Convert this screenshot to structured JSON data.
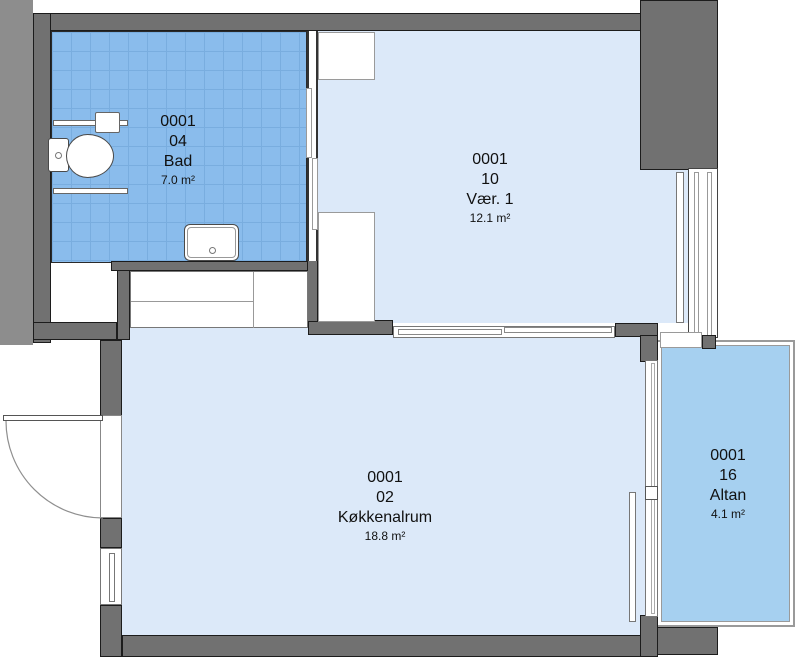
{
  "plan_title": "Apartment 0001 floor plan",
  "colors": {
    "wall": "#717171",
    "wall_outline": "#1c1c1c",
    "margin": "#8d8d8d",
    "room_light": "#dce9f9",
    "tile": "#8abcec",
    "tile_line": "#79addf",
    "balcony": "#a6d0f0",
    "frame_line": "#9a9a9a",
    "frame_dark": "#555555",
    "text": "#111111"
  },
  "rooms": [
    {
      "unit": "0001",
      "number": "04",
      "name": "Bad",
      "area": "7.0 m²"
    },
    {
      "unit": "0001",
      "number": "10",
      "name": "Vær. 1",
      "area": "12.1 m²"
    },
    {
      "unit": "0001",
      "number": "02",
      "name": "Køkkenalrum",
      "area": "18.8 m²"
    },
    {
      "unit": "0001",
      "number": "16",
      "name": "Altan",
      "area": "4.1 m²"
    }
  ]
}
